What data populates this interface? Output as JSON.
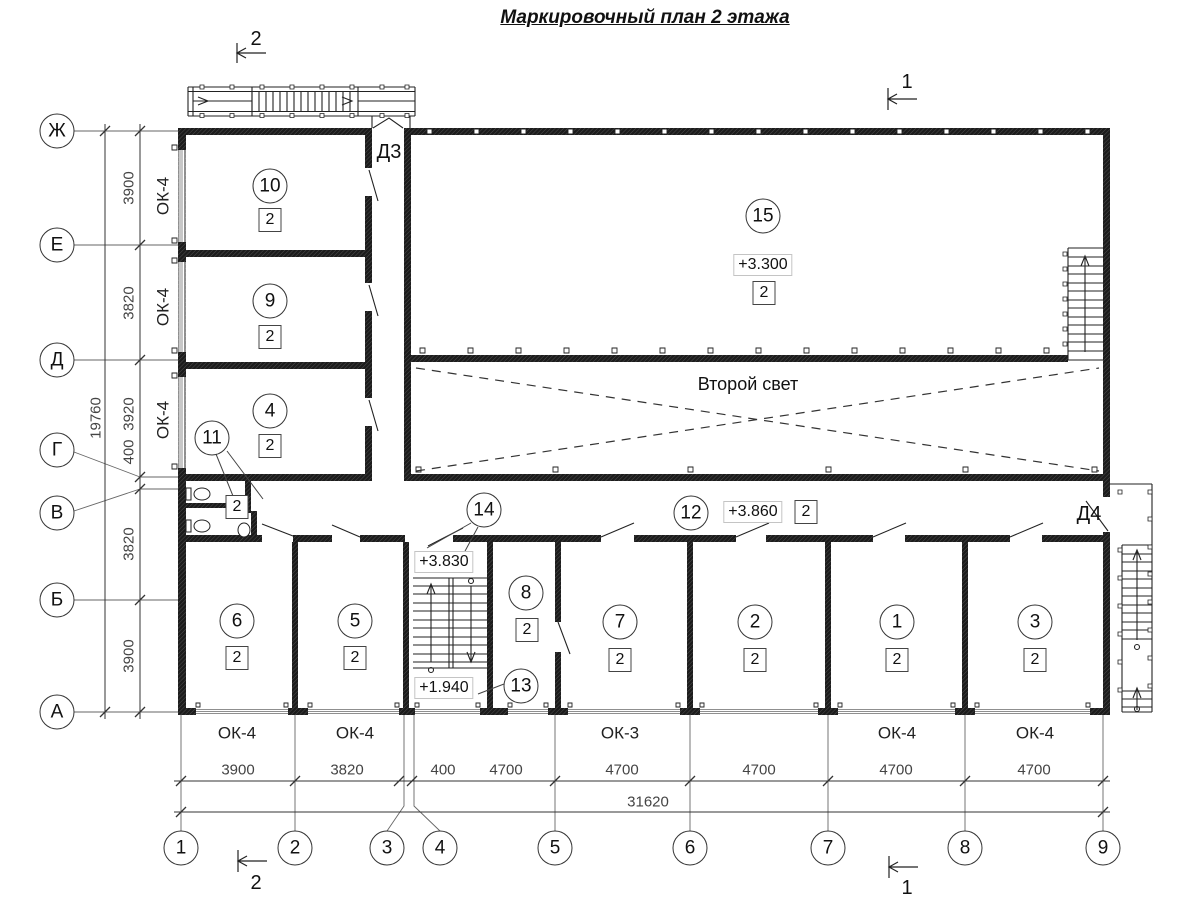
{
  "title": "Маркировочный план 2 этажа",
  "axes": {
    "rows": [
      "Ж",
      "Е",
      "Д",
      "Г",
      "В",
      "Б",
      "А"
    ],
    "cols": [
      "1",
      "2",
      "3",
      "4",
      "5",
      "6",
      "7",
      "8",
      "9"
    ]
  },
  "dims": {
    "left_segments": [
      "3900",
      "3820",
      "3920",
      "400",
      "3820",
      "3900"
    ],
    "left_total": "19760",
    "bottom_segments": [
      "3900",
      "3820",
      "400",
      "4700",
      "4700",
      "4700",
      "4700",
      "4700"
    ],
    "bottom_total": "31620"
  },
  "window_marks": {
    "left": [
      "ОК-4",
      "ОК-4",
      "ОК-4"
    ],
    "bottom": [
      "ОК-4",
      "ОК-4",
      "ОК-3",
      "ОК-4",
      "ОК-4"
    ]
  },
  "rooms": {
    "r10": {
      "num": "10",
      "cat": "2"
    },
    "r9": {
      "num": "9",
      "cat": "2"
    },
    "r4": {
      "num": "4",
      "cat": "2"
    },
    "r15": {
      "num": "15",
      "cat": "2",
      "level": "+3.300"
    },
    "r11": {
      "num": "11",
      "cat": "2"
    },
    "r12": {
      "num": "12",
      "cat": "2",
      "level": "+3.860"
    },
    "r14": {
      "num": "14",
      "level": "+3.830"
    },
    "r13": {
      "num": "13",
      "level": "+1.940"
    },
    "r8": {
      "num": "8",
      "cat": "2"
    },
    "r6": {
      "num": "6",
      "cat": "2"
    },
    "r5": {
      "num": "5",
      "cat": "2"
    },
    "r7": {
      "num": "7",
      "cat": "2"
    },
    "r2": {
      "num": "2",
      "cat": "2"
    },
    "r1": {
      "num": "1",
      "cat": "2"
    },
    "r3": {
      "num": "3",
      "cat": "2"
    }
  },
  "doors": {
    "d3": "Д3",
    "d4": "Д4"
  },
  "void_label": "Второй свет",
  "sections": {
    "top_left": "2",
    "top_right": "1",
    "bottom_left": "2",
    "bottom_right": "1"
  }
}
